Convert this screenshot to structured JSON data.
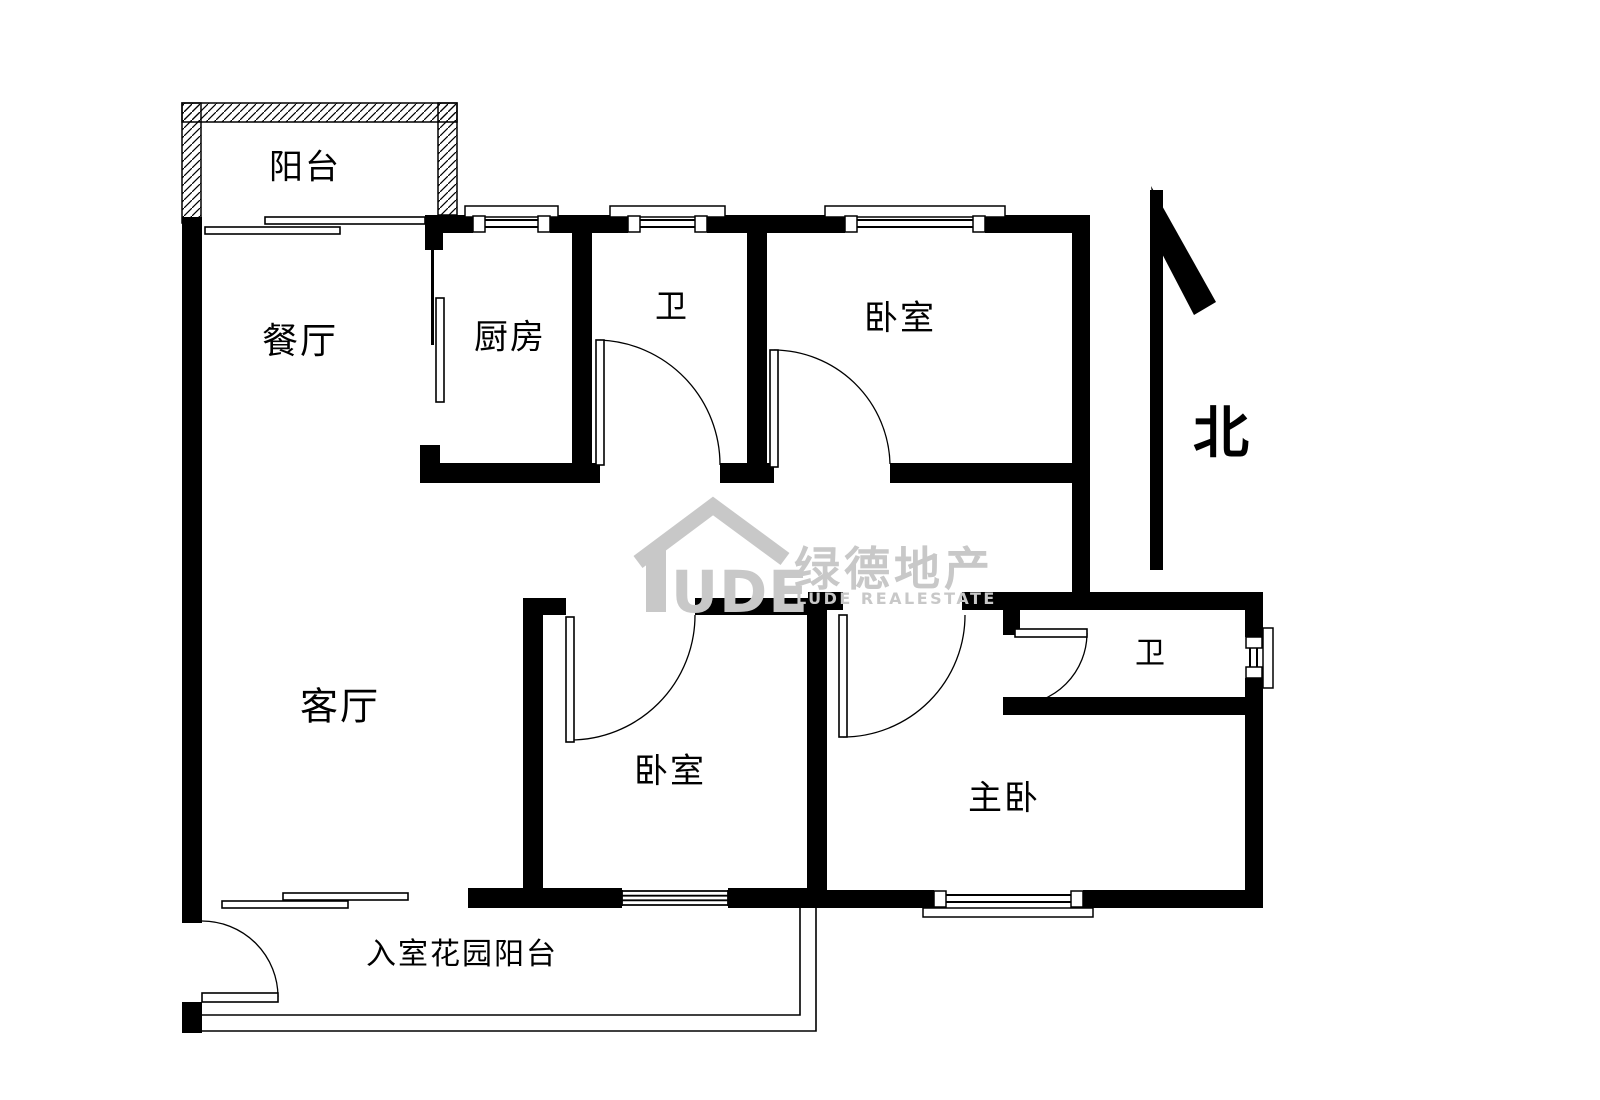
{
  "canvas": {
    "width": 1600,
    "height": 1100,
    "background": "#ffffff",
    "ink": "#000000",
    "watermark_color": "#c8c8c8"
  },
  "rooms": [
    {
      "id": "balcony",
      "label": "阳台",
      "x": 305,
      "y": 164,
      "size": 34
    },
    {
      "id": "dining",
      "label": "餐厅",
      "x": 300,
      "y": 338,
      "size": 36
    },
    {
      "id": "kitchen",
      "label": "厨房",
      "x": 510,
      "y": 334,
      "size": 34
    },
    {
      "id": "bath-top",
      "label": "卫",
      "x": 672,
      "y": 304,
      "size": 32
    },
    {
      "id": "bedroom-top",
      "label": "卧室",
      "x": 900,
      "y": 315,
      "size": 34
    },
    {
      "id": "living",
      "label": "客厅",
      "x": 340,
      "y": 703,
      "size": 38
    },
    {
      "id": "bedroom-mid",
      "label": "卧室",
      "x": 670,
      "y": 768,
      "size": 34
    },
    {
      "id": "bath-master",
      "label": "卫",
      "x": 1151,
      "y": 650,
      "size": 30
    },
    {
      "id": "master",
      "label": "主卧",
      "x": 1004,
      "y": 795,
      "size": 34
    },
    {
      "id": "entry-garden",
      "label": "入室花园阳台",
      "x": 462,
      "y": 951,
      "size": 30
    }
  ],
  "north": {
    "label": "北",
    "x": 1221,
    "y": 429,
    "size": 56,
    "shaft": [
      1150,
      190,
      13,
      380
    ],
    "head": "1151,186 1216,302 1194,315 1158,246"
  },
  "watermark": {
    "logo_text": "UDE",
    "brand_cn": "绿德地产",
    "brand_en": "LUDE REALESTATE",
    "roof_path": "M638 562 L713 506 L785 559",
    "bar": [
      646,
      549,
      20,
      63
    ],
    "ude_pos": [
      671,
      612,
      58
    ],
    "cn_pos": [
      794,
      585,
      46
    ],
    "en_pos": [
      796,
      604,
      16
    ]
  },
  "geometry": {
    "hatch_bands": [
      [
        182,
        103,
        275,
        19
      ],
      [
        182,
        103,
        19,
        120
      ],
      [
        438,
        103,
        19,
        112
      ]
    ],
    "walls": [
      [
        182,
        217,
        20,
        706
      ],
      [
        182,
        1002,
        20,
        31
      ],
      [
        425,
        215,
        48,
        18
      ],
      [
        550,
        215,
        78,
        18
      ],
      [
        707,
        215,
        138,
        18
      ],
      [
        985,
        215,
        105,
        18
      ],
      [
        425,
        217,
        18,
        33
      ],
      [
        420,
        445,
        20,
        38
      ],
      [
        420,
        463,
        180,
        20
      ],
      [
        572,
        217,
        20,
        248
      ],
      [
        747,
        217,
        20,
        248
      ],
      [
        720,
        463,
        54,
        20
      ],
      [
        890,
        463,
        200,
        20
      ],
      [
        1072,
        217,
        18,
        393
      ],
      [
        808,
        592,
        35,
        18
      ],
      [
        962,
        592,
        301,
        18
      ],
      [
        1003,
        610,
        17,
        25
      ],
      [
        1003,
        697,
        260,
        18
      ],
      [
        1245,
        592,
        18,
        45
      ],
      [
        1245,
        678,
        18,
        230
      ],
      [
        825,
        890,
        109,
        18
      ],
      [
        1083,
        890,
        180,
        18
      ],
      [
        523,
        598,
        20,
        292
      ],
      [
        523,
        598,
        43,
        17
      ],
      [
        695,
        598,
        130,
        17
      ],
      [
        807,
        598,
        20,
        310
      ],
      [
        468,
        888,
        154,
        20
      ],
      [
        728,
        888,
        97,
        20
      ]
    ],
    "windows_top": [
      {
        "x1": 473,
        "x2": 550,
        "y": 215,
        "h": 18,
        "sill": [
          465,
          206,
          93,
          11
        ]
      },
      {
        "x1": 628,
        "x2": 707,
        "y": 215,
        "h": 18,
        "sill": [
          610,
          206,
          115,
          11
        ]
      },
      {
        "x1": 845,
        "x2": 985,
        "y": 215,
        "h": 18,
        "sill": [
          825,
          206,
          180,
          11
        ]
      }
    ],
    "window_right": {
      "x": 1245,
      "w": 18,
      "y1": 637,
      "y2": 678,
      "sill": [
        1263,
        628,
        10,
        60
      ]
    },
    "window_bottom": {
      "x1": 934,
      "x2": 1083,
      "y": 890,
      "h": 18,
      "sill": [
        923,
        908,
        170,
        9
      ]
    },
    "window_lines": {
      "x1": 622,
      "x2": 728,
      "y": 889,
      "h": 18,
      "count": 4
    },
    "sliding_panels": [
      [
        265,
        217,
        160,
        7
      ],
      [
        205,
        227,
        135,
        7
      ],
      [
        283,
        893,
        125,
        7
      ],
      [
        222,
        901,
        126,
        7
      ],
      [
        436,
        298,
        8,
        104
      ]
    ],
    "tracks": [
      [
        431,
        240,
        3,
        105
      ]
    ],
    "doors": [
      {
        "leaf": [
          596,
          340,
          8,
          125
        ],
        "arc": "M 600 340 A 125 125 0 0 1 720 465"
      },
      {
        "leaf": [
          770,
          350,
          8,
          117
        ],
        "arc": "M 774 350 A 117 117 0 0 1 890 464"
      },
      {
        "leaf": [
          566,
          617,
          8,
          125
        ],
        "arc": "M 570 740 A 125 125 0 0 0 695 615"
      },
      {
        "leaf": [
          839,
          615,
          8,
          122
        ],
        "arc": "M 843 737 A 122 122 0 0 0 965 615"
      },
      {
        "leaf": [
          1015,
          629,
          72,
          8
        ],
        "arc": "M 1087 633 A 72 72 0 0 1 1015 705"
      },
      {
        "leaf": [
          202,
          993,
          76,
          9
        ],
        "arc": "M 278 997 A 76 76 0 0 0 202 921"
      }
    ],
    "terrace_paths": [
      "M 202 1015 H 800 V 908",
      "M 190 1031 H 816 V 908"
    ]
  }
}
